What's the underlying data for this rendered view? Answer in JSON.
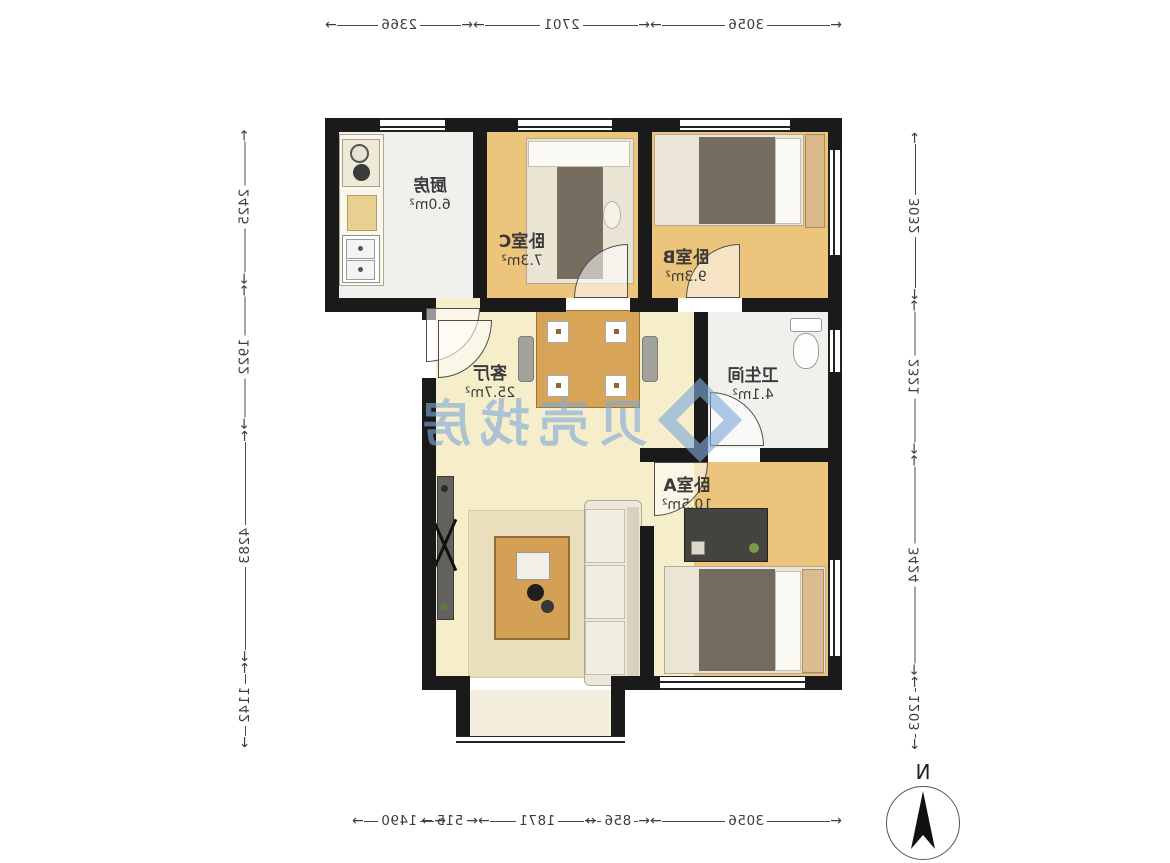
{
  "floor_plan": {
    "rooms": {
      "kitchen": {
        "name": "厨房",
        "area": "6.0m²"
      },
      "bedroom_c": {
        "name": "卧室C",
        "area": "7.3m²"
      },
      "bedroom_b": {
        "name": "卧室B",
        "area": "9.3m²"
      },
      "living_room": {
        "name": "客厅",
        "area": "25.7m²"
      },
      "bathroom": {
        "name": "卫生间",
        "area": "4.1m²"
      },
      "bedroom_a": {
        "name": "卧室A",
        "area": "10.5m²"
      }
    },
    "dimensions_mm": {
      "top": [
        "2366",
        "2701",
        "3056"
      ],
      "bottom": [
        "1490",
        "515",
        "1871",
        "856",
        "3056"
      ],
      "left": [
        "2425",
        "1922",
        "4283",
        "1142"
      ],
      "right": [
        "3032",
        "2321",
        "3424",
        "1203"
      ]
    },
    "compass": {
      "label": "N"
    },
    "watermark": {
      "text": "贝壳找房"
    },
    "colors": {
      "wall": "#1a1a1a",
      "wood_floor": "#ecc47c",
      "living_floor": "#f6eecb",
      "tile_floor": "#f0f0ec",
      "watermark_blue": "#7fa9d8"
    }
  }
}
